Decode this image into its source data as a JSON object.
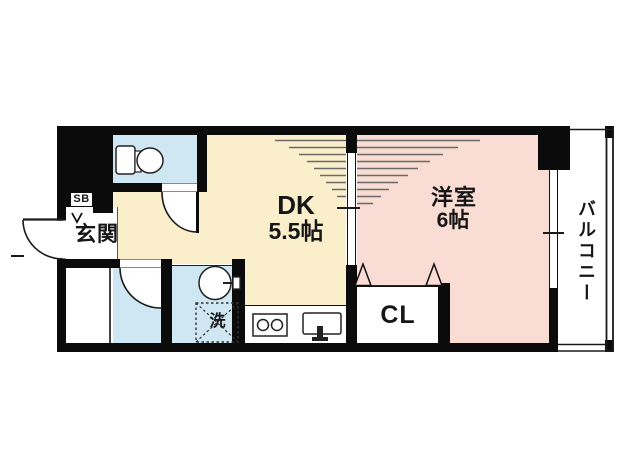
{
  "floorplan": {
    "labels": {
      "entrance": "玄関",
      "dk_name": "DK",
      "dk_size": "5.5帖",
      "western_name": "洋室",
      "western_size": "6帖",
      "closet": "CL",
      "shoe_box": "SB",
      "laundry": "洗",
      "balcony": "バルコニー"
    },
    "colors": {
      "wall": "#0b0b0b",
      "dk": "#faeecb",
      "west": "#f9dcd3",
      "wet": "#cfe6f3",
      "line": "#1a1a1a"
    }
  }
}
